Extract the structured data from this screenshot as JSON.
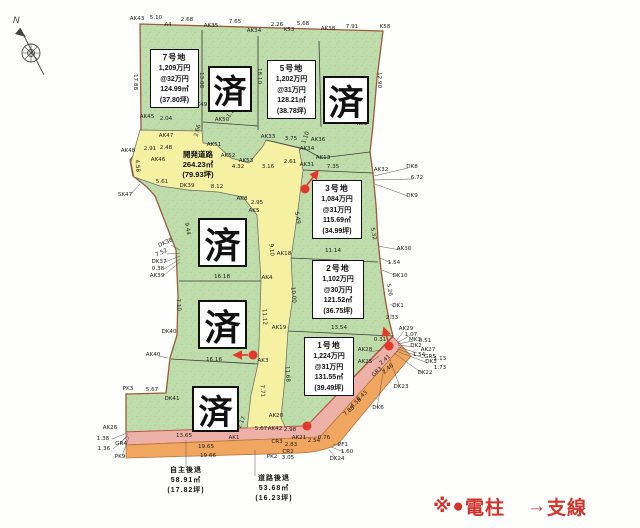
{
  "compass": {
    "north_label": "N"
  },
  "legend": {
    "prefix": "※",
    "pole_symbol": "●",
    "pole_label": "電柱",
    "wire_symbol": "→",
    "wire_label": "支線",
    "color": "#d0342c"
  },
  "sold_stamp": {
    "label": "済",
    "count": 5
  },
  "plots": [
    {
      "id": "7",
      "name": "7号地",
      "price": "1,209万円",
      "unit_price": "@32万円",
      "area": "124.99㎡",
      "tsubo": "(37.80坪)"
    },
    {
      "id": "5",
      "name": "5号地",
      "price": "1,202万円",
      "unit_price": "@31万円",
      "area": "128.21㎡",
      "tsubo": "(38.78坪)"
    },
    {
      "id": "3",
      "name": "3号地",
      "price": "1,084万円",
      "unit_price": "@31万円",
      "area": "115.69㎡",
      "tsubo": "(34.99坪)"
    },
    {
      "id": "2",
      "name": "2号地",
      "price": "1,102万円",
      "unit_price": "@30万円",
      "area": "121.52㎡",
      "tsubo": "(36.75坪)"
    },
    {
      "id": "1",
      "name": "1号地",
      "price": "1,224万円",
      "unit_price": "@31万円",
      "area": "131.55㎡",
      "tsubo": "(39.49坪)"
    }
  ],
  "development_road": {
    "name": "開発道路",
    "area": "264.23㎡",
    "tsubo": "(79.93坪)"
  },
  "setbacks": {
    "self": {
      "label": "自主後退",
      "area": "58.91㎡",
      "tsubo": "(17.82坪)"
    },
    "road": {
      "label": "道路後退",
      "area": "53.68㎡",
      "tsubo": "(16.23坪)"
    }
  },
  "colors": {
    "parcel_green": "#bfdcab",
    "road_yellow": "#f6f0a2",
    "setback_pink": "#eeb1a8",
    "setback_orange": "#f1a660",
    "boundary_brown": "#9c5a3c",
    "pole_red": "#e2392a"
  },
  "map_labels": [
    {
      "t": "AK43",
      "x": 137,
      "y": 20
    },
    {
      "t": "5.10",
      "x": 156,
      "y": 19
    },
    {
      "t": "A4",
      "x": 168,
      "y": 26
    },
    {
      "t": "2.68",
      "x": 187,
      "y": 21
    },
    {
      "t": "AK35",
      "x": 211,
      "y": 27
    },
    {
      "t": "7.65",
      "x": 235,
      "y": 23
    },
    {
      "t": "AK34",
      "x": 254,
      "y": 32
    },
    {
      "t": "2.26",
      "x": 277,
      "y": 26
    },
    {
      "t": "K53",
      "x": 289,
      "y": 31
    },
    {
      "t": "5.68",
      "x": 303,
      "y": 25
    },
    {
      "t": "AK38",
      "x": 328,
      "y": 30
    },
    {
      "t": "7.91",
      "x": 352,
      "y": 28
    },
    {
      "t": "K58",
      "x": 385,
      "y": 28
    },
    {
      "t": "17.88",
      "x": 134,
      "y": 82,
      "r": 90
    },
    {
      "t": "13.08",
      "x": 200,
      "y": 80,
      "r": 90
    },
    {
      "t": "18.10",
      "x": 258,
      "y": 76,
      "r": 90
    },
    {
      "t": "12.90",
      "x": 378,
      "y": 80,
      "r": 90
    },
    {
      "t": "K51",
      "x": 362,
      "y": 125
    },
    {
      "t": "AK45",
      "x": 147,
      "y": 118
    },
    {
      "t": "2.04",
      "x": 166,
      "y": 120
    },
    {
      "t": "AK49",
      "x": 200,
      "y": 106
    },
    {
      "t": "2.66",
      "x": 199,
      "y": 131,
      "r": -75
    },
    {
      "t": "AK50",
      "x": 222,
      "y": 121
    },
    {
      "t": "1.20",
      "x": 233,
      "y": 113,
      "r": -55
    },
    {
      "t": "AK48",
      "x": 128,
      "y": 152
    },
    {
      "t": "2.91",
      "x": 150,
      "y": 150
    },
    {
      "t": "2.48",
      "x": 166,
      "y": 149
    },
    {
      "t": "AK46",
      "x": 158,
      "y": 161
    },
    {
      "t": "AK47",
      "x": 166,
      "y": 137
    },
    {
      "t": "4.58",
      "x": 136,
      "y": 166,
      "r": 85
    },
    {
      "t": "SK47",
      "x": 125,
      "y": 196
    },
    {
      "t": "AK51",
      "x": 214,
      "y": 146
    },
    {
      "t": "AK52",
      "x": 228,
      "y": 157
    },
    {
      "t": "AK53",
      "x": 246,
      "y": 162
    },
    {
      "t": "4.32",
      "x": 238,
      "y": 168
    },
    {
      "t": "3.16",
      "x": 268,
      "y": 168
    },
    {
      "t": "2.61",
      "x": 290,
      "y": 163
    },
    {
      "t": "AK33",
      "x": 268,
      "y": 138
    },
    {
      "t": "3.75",
      "x": 291,
      "y": 140
    },
    {
      "t": "1.10",
      "x": 307,
      "y": 138,
      "r": -70
    },
    {
      "t": "AK36",
      "x": 318,
      "y": 141
    },
    {
      "t": "AK34",
      "x": 307,
      "y": 150
    },
    {
      "t": "AK13",
      "x": 323,
      "y": 159
    },
    {
      "t": "5.61",
      "x": 162,
      "y": 183
    },
    {
      "t": "DK39",
      "x": 187,
      "y": 187
    },
    {
      "t": "8.12",
      "x": 217,
      "y": 188
    },
    {
      "t": "AK8",
      "x": 242,
      "y": 200
    },
    {
      "t": "2.95",
      "x": 257,
      "y": 204
    },
    {
      "t": "AK5",
      "x": 254,
      "y": 212
    },
    {
      "t": "5.49",
      "x": 296,
      "y": 218,
      "r": 80
    },
    {
      "t": "AK31",
      "x": 307,
      "y": 166
    },
    {
      "t": "7.35",
      "x": 333,
      "y": 168
    },
    {
      "t": "AK32",
      "x": 381,
      "y": 171
    },
    {
      "t": "DK8",
      "x": 412,
      "y": 168
    },
    {
      "t": "6.72",
      "x": 417,
      "y": 179
    },
    {
      "t": "DK9",
      "x": 412,
      "y": 197
    },
    {
      "t": "5.32",
      "x": 372,
      "y": 234,
      "r": 78
    },
    {
      "t": "AK30",
      "x": 404,
      "y": 250
    },
    {
      "t": "1.54",
      "x": 394,
      "y": 264
    },
    {
      "t": "DK10",
      "x": 400,
      "y": 277
    },
    {
      "t": "5.26",
      "x": 388,
      "y": 290,
      "r": 80
    },
    {
      "t": "DK1",
      "x": 398,
      "y": 307
    },
    {
      "t": "2.33",
      "x": 392,
      "y": 319
    },
    {
      "t": "11.14",
      "x": 333,
      "y": 252
    },
    {
      "t": "13.54",
      "x": 339,
      "y": 329
    },
    {
      "t": "9.10",
      "x": 270,
      "y": 250,
      "r": 85
    },
    {
      "t": "10.00",
      "x": 292,
      "y": 295,
      "r": 85
    },
    {
      "t": "11.12",
      "x": 263,
      "y": 317,
      "r": 87
    },
    {
      "t": "16.18",
      "x": 222,
      "y": 278
    },
    {
      "t": "AK4",
      "x": 267,
      "y": 279
    },
    {
      "t": "AK18",
      "x": 284,
      "y": 255
    },
    {
      "t": "AK19",
      "x": 279,
      "y": 329
    },
    {
      "t": "DK38",
      "x": 166,
      "y": 244,
      "r": -25
    },
    {
      "t": "7.52",
      "x": 162,
      "y": 254,
      "r": -25
    },
    {
      "t": "DK37",
      "x": 159,
      "y": 263
    },
    {
      "t": "0.38",
      "x": 158,
      "y": 270
    },
    {
      "t": "AK39",
      "x": 157,
      "y": 277
    },
    {
      "t": "9.44",
      "x": 186,
      "y": 229,
      "r": 80
    },
    {
      "t": "7.10",
      "x": 177,
      "y": 305,
      "r": 85
    },
    {
      "t": "DK40",
      "x": 169,
      "y": 333
    },
    {
      "t": "AK40",
      "x": 153,
      "y": 356
    },
    {
      "t": "16.16",
      "x": 214,
      "y": 361
    },
    {
      "t": "AK3",
      "x": 263,
      "y": 362
    },
    {
      "t": "7.71",
      "x": 261,
      "y": 391,
      "r": 87
    },
    {
      "t": "PK3",
      "x": 128,
      "y": 390
    },
    {
      "t": "5.67",
      "x": 152,
      "y": 391
    },
    {
      "t": "DK41",
      "x": 172,
      "y": 400
    },
    {
      "t": "2.17",
      "x": 243,
      "y": 423,
      "r": -65
    },
    {
      "t": "11.68",
      "x": 286,
      "y": 374,
      "r": 87
    },
    {
      "t": "AK20",
      "x": 276,
      "y": 417
    },
    {
      "t": "5.67",
      "x": 261,
      "y": 430
    },
    {
      "t": "AK42",
      "x": 275,
      "y": 430
    },
    {
      "t": "2.98",
      "x": 290,
      "y": 431
    },
    {
      "t": "AK21",
      "x": 299,
      "y": 439
    },
    {
      "t": "CR3",
      "x": 277,
      "y": 443
    },
    {
      "t": "2.83",
      "x": 291,
      "y": 446
    },
    {
      "t": "CR2",
      "x": 288,
      "y": 453
    },
    {
      "t": "PK2",
      "x": 272,
      "y": 458
    },
    {
      "t": "3.05",
      "x": 288,
      "y": 459
    },
    {
      "t": "13.65",
      "x": 184,
      "y": 437
    },
    {
      "t": "AK1",
      "x": 234,
      "y": 439
    },
    {
      "t": "19.65",
      "x": 206,
      "y": 448
    },
    {
      "t": "19.66",
      "x": 208,
      "y": 457
    },
    {
      "t": "AK26",
      "x": 110,
      "y": 429
    },
    {
      "t": "1.38",
      "x": 103,
      "y": 440
    },
    {
      "t": "GR4",
      "x": 121,
      "y": 445
    },
    {
      "t": "1.36",
      "x": 104,
      "y": 450
    },
    {
      "t": "PK9",
      "x": 120,
      "y": 458
    },
    {
      "t": "AK29",
      "x": 406,
      "y": 330
    },
    {
      "t": "1.07",
      "x": 411,
      "y": 336
    },
    {
      "t": "MK3",
      "x": 415,
      "y": 341
    },
    {
      "t": "0.51",
      "x": 425,
      "y": 342
    },
    {
      "t": "DK2",
      "x": 416,
      "y": 347
    },
    {
      "t": "AK27",
      "x": 428,
      "y": 351
    },
    {
      "t": "1.54",
      "x": 419,
      "y": 356
    },
    {
      "t": "GR5",
      "x": 430,
      "y": 358
    },
    {
      "t": "1.13",
      "x": 440,
      "y": 360
    },
    {
      "t": "DK3",
      "x": 431,
      "y": 363
    },
    {
      "t": "1.73",
      "x": 440,
      "y": 369
    },
    {
      "t": "DK22",
      "x": 425,
      "y": 374
    },
    {
      "t": "DK23",
      "x": 401,
      "y": 388
    },
    {
      "t": "DK6",
      "x": 378,
      "y": 409
    },
    {
      "t": "AK28",
      "x": 365,
      "y": 351
    },
    {
      "t": "AK25",
      "x": 365,
      "y": 363
    },
    {
      "t": "0.31",
      "x": 380,
      "y": 341
    },
    {
      "t": "2.41",
      "x": 386,
      "y": 361,
      "r": -42
    },
    {
      "t": "GR3",
      "x": 378,
      "y": 373,
      "r": -42
    },
    {
      "t": "2.46",
      "x": 389,
      "y": 370,
      "r": -42
    },
    {
      "t": "6.43",
      "x": 363,
      "y": 397,
      "r": -42
    },
    {
      "t": "4.58",
      "x": 357,
      "y": 404,
      "r": -42
    },
    {
      "t": "7.88",
      "x": 350,
      "y": 412,
      "r": -42
    },
    {
      "t": "2.54",
      "x": 314,
      "y": 442
    },
    {
      "t": "0.76",
      "x": 324,
      "y": 439
    },
    {
      "t": "PF1",
      "x": 343,
      "y": 446
    },
    {
      "t": "1.60",
      "x": 347,
      "y": 453
    },
    {
      "t": "DK24",
      "x": 337,
      "y": 460
    }
  ],
  "markers": {
    "poles": [
      {
        "x": 305,
        "y": 189
      },
      {
        "x": 389,
        "y": 346
      },
      {
        "x": 253,
        "y": 355
      },
      {
        "x": 307,
        "y": 426
      }
    ],
    "wires": [
      {
        "x1": 307,
        "y1": 185,
        "x2": 318,
        "y2": 171
      },
      {
        "x1": 388,
        "y1": 341,
        "x2": 384,
        "y2": 328
      },
      {
        "x1": 248,
        "y1": 355,
        "x2": 234,
        "y2": 355
      }
    ]
  }
}
